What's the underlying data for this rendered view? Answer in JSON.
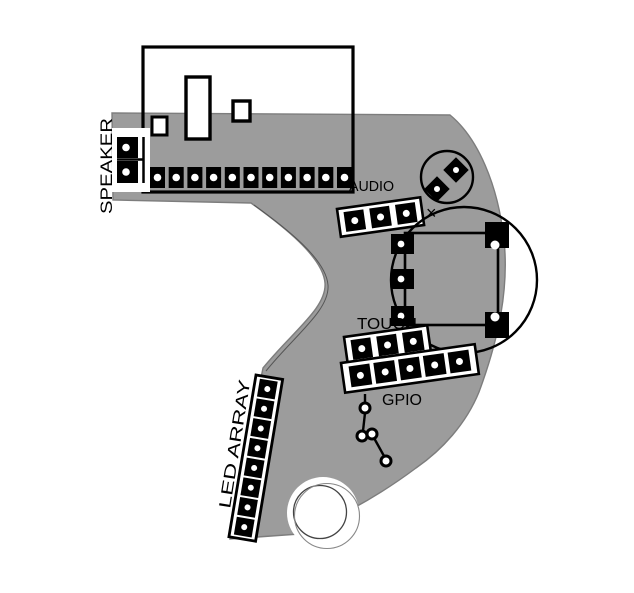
{
  "diagram": {
    "type": "pcb-layout",
    "labels": {
      "speaker": "SPEAKER",
      "audio": "AUDIO",
      "touch": "TOUCH",
      "gpio": "GPIO",
      "led_array": "LED ARRAY",
      "cross_mark": "×"
    },
    "colors": {
      "copper": "#9c9c9c",
      "silkscreen": "#000000",
      "board_outline": "#7d7d7d",
      "background": "#ffffff",
      "hole": "#ffffff"
    },
    "connectors": {
      "module_header": {
        "pins": 11
      },
      "speaker": {
        "pins": 2
      },
      "audio": {
        "pins": 3
      },
      "touch": {
        "pins": 3
      },
      "gpio": {
        "pins": 5
      },
      "led_array": {
        "pins": 8
      },
      "round_component": {
        "pins": 2
      },
      "rotary_encoder": {
        "left_pins": 3,
        "right_pins": 2
      },
      "test_points": {
        "count": 4
      },
      "mounting_circles": {
        "count": 2
      }
    }
  }
}
